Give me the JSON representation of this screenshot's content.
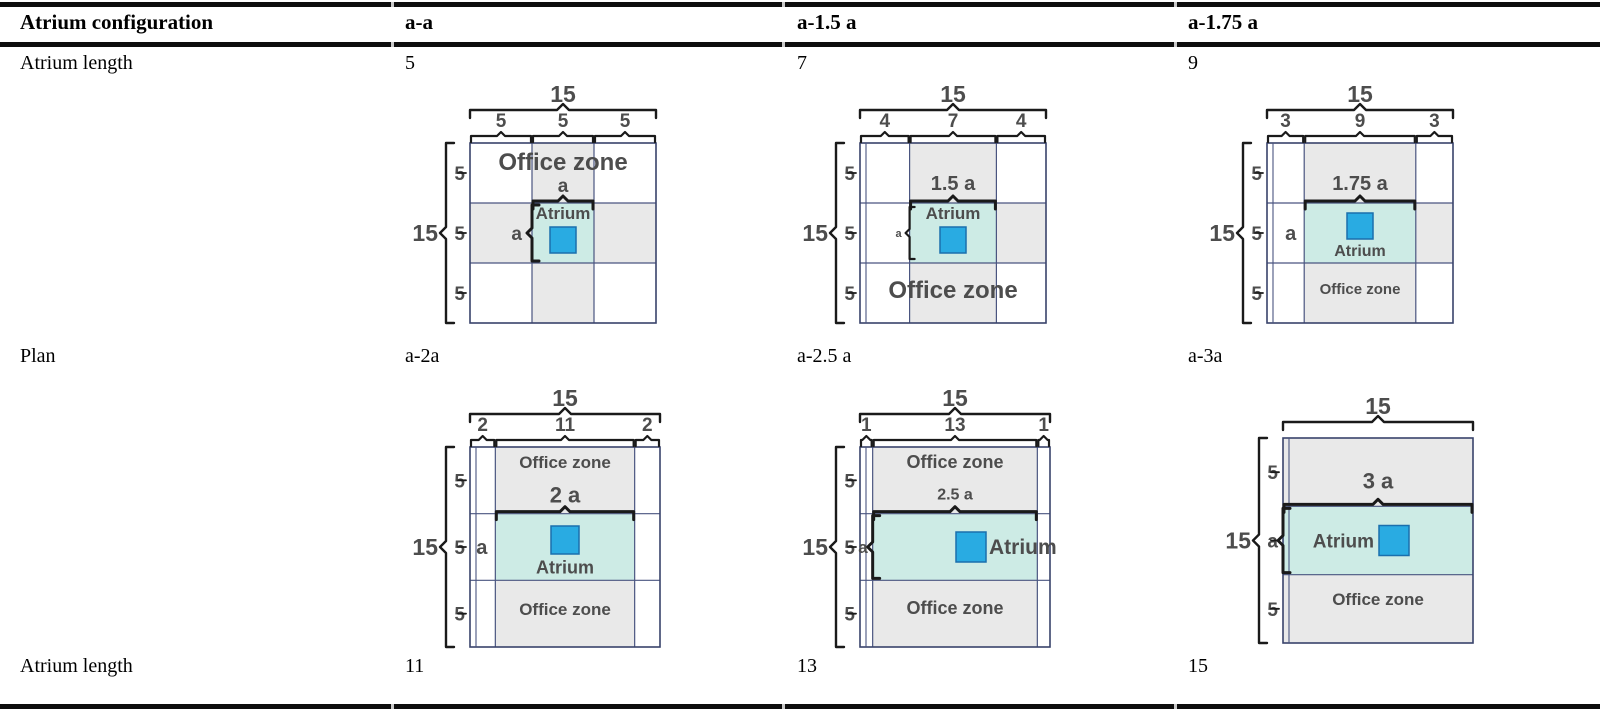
{
  "table": {
    "header": [
      "Atrium configuration",
      "a-a",
      "a-1.5 a",
      "a-1.75 a"
    ],
    "rows": [
      {
        "label": "Atrium length",
        "values": [
          "5",
          "7",
          "9"
        ]
      },
      {
        "label": "Plan",
        "values": [
          "a-2a",
          "a-2.5 a",
          "a-3a"
        ]
      },
      {
        "label": "Atrium length",
        "values": [
          "11",
          "13",
          "15"
        ]
      }
    ]
  },
  "colors": {
    "atrium_fill": "#cdebe5",
    "office_fill": "#e9e9e9",
    "skylight_fill": "#29abe2",
    "skylight_stroke": "#1a6fad",
    "grid_stroke": "#4a5580",
    "grid_outer": "#39436b",
    "diagram_text": "#4d4d4d",
    "bracket": "#1a1a1a",
    "rule": "#0d0d0d",
    "rule_gap": "#c9c9c9"
  },
  "diagrams": [
    {
      "name": "a-a",
      "total_width_label": "15",
      "col_widths": [
        5,
        5,
        5
      ],
      "col_labels": [
        "5",
        "5",
        "5"
      ],
      "total_height_label": "15",
      "row_heights": [
        5,
        5,
        5
      ],
      "row_labels": [
        "5",
        "5",
        "5"
      ],
      "shaded_cells": [
        [
          0,
          1
        ],
        [
          1,
          0
        ],
        [
          1,
          2
        ],
        [
          2,
          1
        ]
      ],
      "atrium_col": 1,
      "atrium_width_label": {
        "text": "a",
        "font": 19,
        "dy": -11
      },
      "atrium_height": {
        "mode": "bracket-large",
        "text": "a",
        "font": 19
      },
      "office_zones": [
        {
          "text": "Office zone",
          "fx": 0.5,
          "fy": 0.15,
          "size": 24
        }
      ],
      "atrium": {
        "label": "Atrium",
        "pos": "top",
        "font": 17,
        "square": 26
      },
      "left_strip": false
    },
    {
      "name": "a-1.5 a",
      "total_width_label": "15",
      "col_widths": [
        4,
        7,
        4
      ],
      "col_labels": [
        "4",
        "7",
        "4"
      ],
      "total_height_label": "15",
      "row_heights": [
        5,
        5,
        5
      ],
      "row_labels": [
        "5",
        "5",
        "5"
      ],
      "shaded_cells": [
        [
          0,
          1
        ],
        [
          1,
          2
        ],
        [
          2,
          1
        ]
      ],
      "atrium_col": 1,
      "atrium_width_label": {
        "text": "1.5 a",
        "font": 20,
        "dy": -13
      },
      "atrium_height": {
        "mode": "bracket-small",
        "text": "a",
        "font": 11
      },
      "office_zones": [
        {
          "text": "Office zone",
          "fx": 0.5,
          "fy": 0.86,
          "size": 24
        }
      ],
      "atrium": {
        "label": "Atrium",
        "pos": "top",
        "font": 17,
        "square": 26
      },
      "left_strip": true
    },
    {
      "name": "a-1.75 a",
      "total_width_label": "15",
      "col_widths": [
        3,
        9,
        3
      ],
      "col_labels": [
        "3",
        "9",
        "3"
      ],
      "total_height_label": "15",
      "row_heights": [
        5,
        5,
        5
      ],
      "row_labels": [
        "5",
        "5",
        "5"
      ],
      "shaded_cells": [
        [
          0,
          1
        ],
        [
          1,
          2
        ],
        [
          2,
          1
        ]
      ],
      "atrium_col": 1,
      "atrium_width_label": {
        "text": "1.75 a",
        "font": 20,
        "dy": -13
      },
      "atrium_height": {
        "mode": "text",
        "text": "a",
        "font": 20
      },
      "office_zones": [
        {
          "text": "Office zone",
          "fx": 0.5,
          "fy": 0.84,
          "size": 15
        }
      ],
      "atrium": {
        "label": "Atrium",
        "pos": "below",
        "font": 16,
        "square": 26
      },
      "left_strip": true
    },
    {
      "name": "a-2a",
      "total_width_label": "15",
      "col_widths": [
        2,
        11,
        2
      ],
      "col_labels": [
        "2",
        "11",
        "2"
      ],
      "total_height_label": "15",
      "row_heights": [
        5,
        5,
        5
      ],
      "row_labels": [
        "5",
        "5",
        "5"
      ],
      "shaded_cells": [
        [
          0,
          1
        ],
        [
          2,
          1
        ]
      ],
      "atrium_col": 1,
      "atrium_width_label": {
        "text": "2 a",
        "font": 22,
        "dy": -11
      },
      "atrium_height": {
        "mode": "text",
        "text": "a",
        "font": 20
      },
      "office_zones": [
        {
          "text": "Office zone",
          "fx": 0.5,
          "fy": 0.105,
          "size": 17
        },
        {
          "text": "Office zone",
          "fx": 0.5,
          "fy": 0.84,
          "size": 17
        }
      ],
      "atrium": {
        "label": "Atrium",
        "pos": "below",
        "font": 18,
        "square": 28
      },
      "left_strip": true
    },
    {
      "name": "a-2.5 a",
      "total_width_label": "15",
      "col_widths": [
        1,
        13,
        1
      ],
      "col_labels": [
        "1",
        "13",
        "1"
      ],
      "total_height_label": "15",
      "row_heights": [
        5,
        5,
        5
      ],
      "row_labels": [
        "5",
        "5",
        "5"
      ],
      "shaded_cells": [
        [
          0,
          1
        ],
        [
          2,
          1
        ]
      ],
      "atrium_col": 1,
      "atrium_width_label": {
        "text": "2.5 a",
        "font": 16,
        "dy": -14
      },
      "atrium_height": {
        "mode": "bracket-left",
        "text": "a",
        "font": 17
      },
      "office_zones": [
        {
          "text": "Office zone",
          "fx": 0.5,
          "fy": 0.105,
          "size": 18
        },
        {
          "text": "Office zone",
          "fx": 0.5,
          "fy": 0.835,
          "size": 18
        }
      ],
      "atrium": {
        "label": "Atrium",
        "pos": "right",
        "font": 21,
        "square": 30
      },
      "left_strip": true
    },
    {
      "name": "a-3a",
      "total_width_label": "15",
      "col_widths": [
        15
      ],
      "col_labels": [],
      "total_height_label": "15",
      "row_heights": [
        5,
        5,
        5
      ],
      "row_labels": [
        "5",
        "a",
        "5"
      ],
      "shaded_cells": [
        [
          0,
          0
        ],
        [
          2,
          0
        ]
      ],
      "atrium_col": 0,
      "atrium_width_label": {
        "text": "3 a",
        "font": 22,
        "dy": -18
      },
      "atrium_height": {
        "mode": "bracket-edge",
        "text": "",
        "font": 0
      },
      "office_zones": [
        {
          "text": "Office zone",
          "fx": 0.5,
          "fy": 0.815,
          "size": 17
        }
      ],
      "atrium": {
        "label": "Atrium",
        "pos": "left",
        "font": 19,
        "square": 30
      },
      "left_strip": true
    }
  ]
}
